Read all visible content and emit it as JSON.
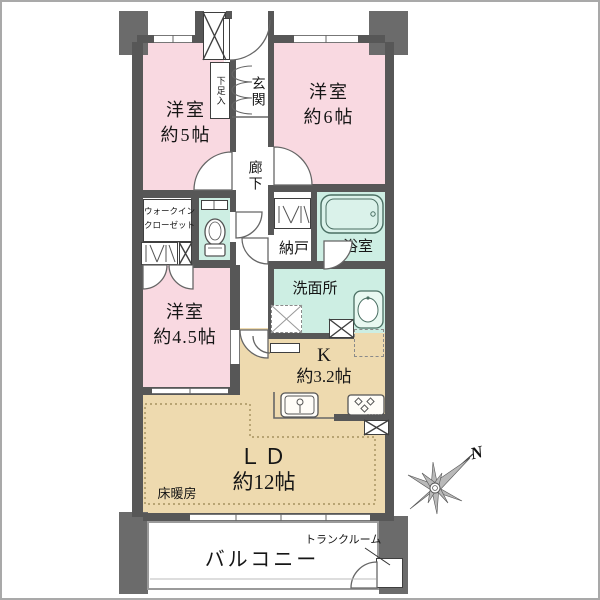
{
  "rooms": {
    "bedroom_5": {
      "name": "洋室",
      "size": "約5帖"
    },
    "bedroom_6": {
      "name": "洋室",
      "size": "約6帖"
    },
    "bedroom_4_5": {
      "name": "洋室",
      "size": "約4.5帖"
    },
    "living_dining span": {
      "name": ""
    },
    "living_dining": {
      "name": "ＬＤ",
      "size": "約12帖"
    },
    "kitchen": {
      "name": "K",
      "size": "約3.2帖"
    },
    "entrance": {
      "name": "玄関"
    },
    "hallway": {
      "name": "廊下"
    },
    "shoe_cabinet": {
      "name": "下足入"
    },
    "walk_in_closet": {
      "line1": "ウォークイン",
      "line2": "クローゼット"
    },
    "storage": {
      "name": "納戸"
    },
    "bathroom": {
      "name": "浴室"
    },
    "washroom": {
      "name": "洗面所"
    },
    "balcony": {
      "name": "バルコニー"
    },
    "trunk_room": {
      "name": "トランクルーム"
    },
    "floor_heating": {
      "name": "床暖房"
    }
  },
  "compass": {
    "north": "N"
  },
  "colors": {
    "wall": "#575757",
    "block": "#6b6b6b",
    "bedroom": "#f9d9e1",
    "wet": "#cdeee3",
    "ldk": "#eedaaf",
    "text": "#161616",
    "line": "#555555",
    "balcony_border": "#9a9a9a"
  }
}
